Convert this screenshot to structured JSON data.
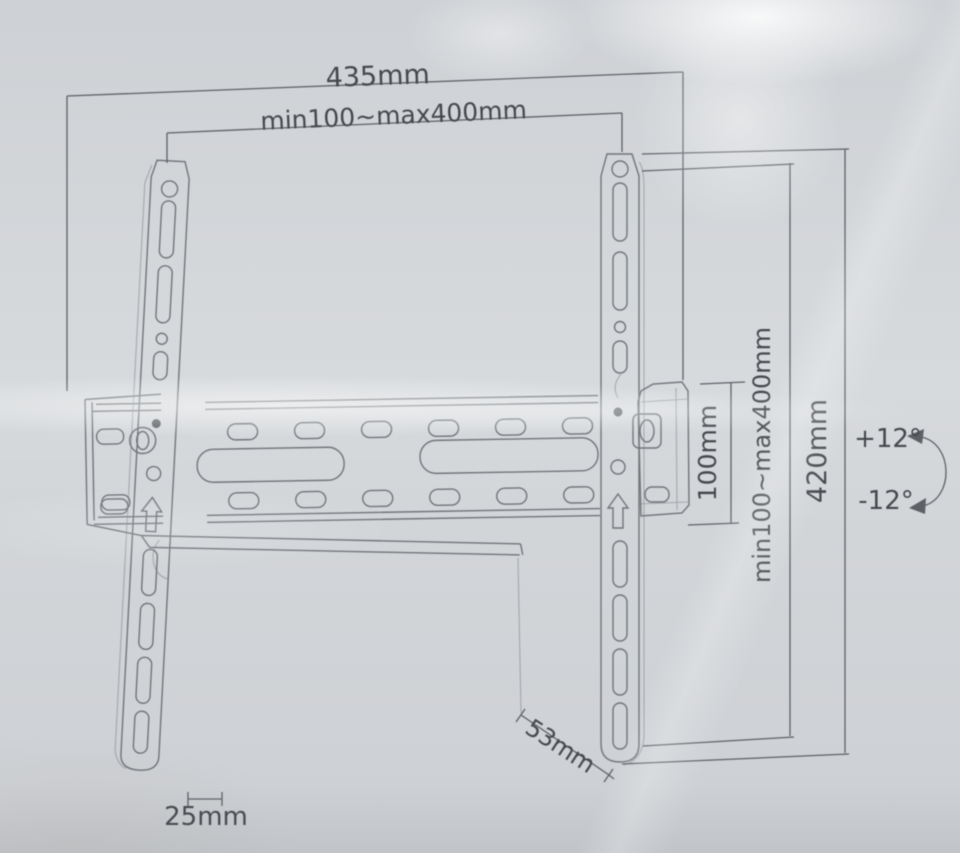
{
  "photo": {
    "description": "Technical diagram of tilting TV wall mount bracket printed on packaging",
    "background_color": "#d3d6d9",
    "line_color": "#70757a",
    "text_color": "#45494d"
  },
  "dimensions": {
    "total_width": "435mm",
    "vesa_width_range": "min100~max400mm",
    "bracket_height": "100mm",
    "vesa_height_range": "min100~max400mm",
    "total_height": "420mm",
    "tilt_up": "+12°",
    "tilt_down": "-12°",
    "depth": "53mm",
    "rail_width": "25mm"
  }
}
